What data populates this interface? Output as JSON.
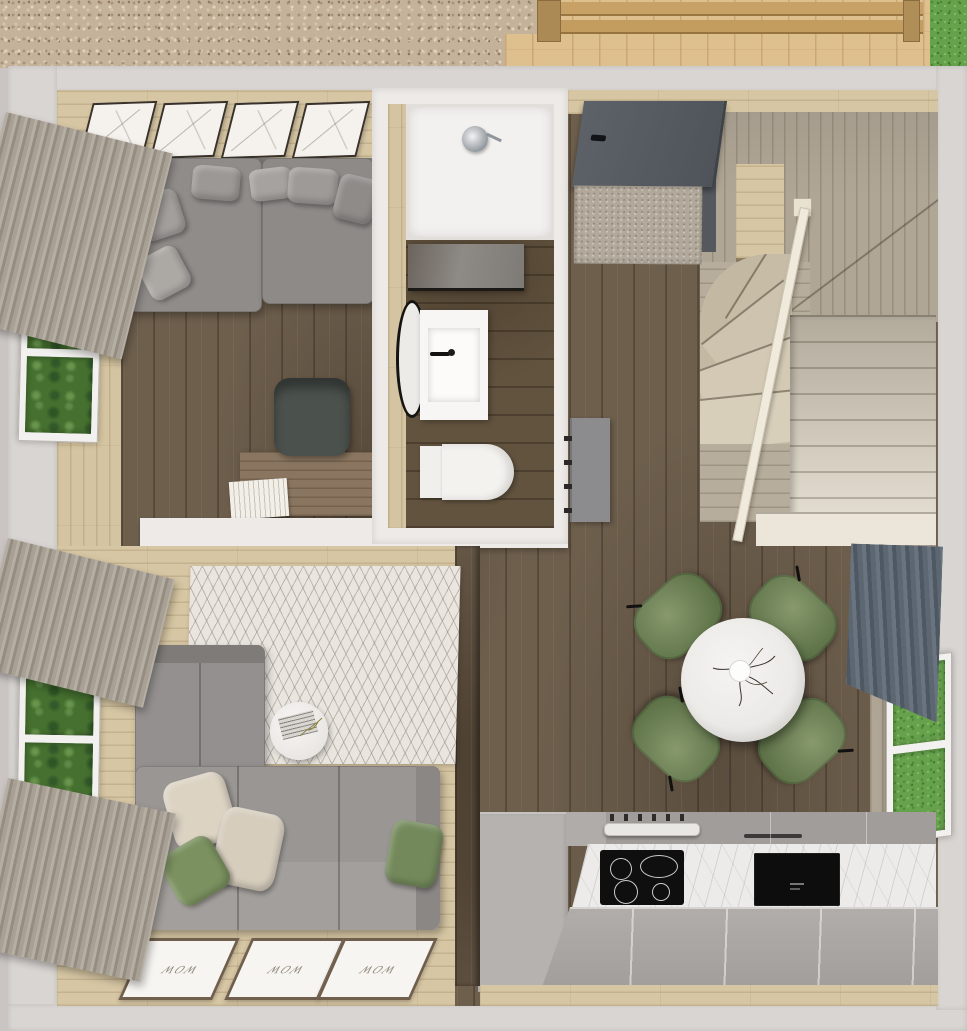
{
  "scene": {
    "type": "3D rendered floor plan, top-down view",
    "description": "Tiny house interior seen from above: lounge-office, bathroom, entry hall with winder staircase, dining corner, kitchen and living room. Gravel, a wooden pergola deck and lawn are visible outside."
  },
  "labels": {
    "floor_mat_text": "WOW"
  },
  "rooms": {
    "lounge_office": {
      "name": "Lounge / Office",
      "items": [
        "gray sectional sofa",
        "6 gray throw pillows",
        "4 framed botanical sketches",
        "wood desk",
        "dark office chair",
        "stack of books",
        "window with forest view",
        "gray pleated curtain"
      ]
    },
    "bathroom": {
      "name": "Bathroom",
      "items": [
        "walk-in shower with rain head",
        "glass panel",
        "round black-rim mirror",
        "white vanity sink with black faucet",
        "wall-hung toilet",
        "gray door"
      ]
    },
    "hallway": {
      "name": "Entry hall",
      "items": [
        "dark gray entry door",
        "door mat",
        "winder staircase",
        "cream handrail",
        "upper landing"
      ]
    },
    "dining": {
      "name": "Dining corner",
      "items": [
        "round white marble table",
        "vase with dry branches",
        "4 green upholstered chairs"
      ]
    },
    "kitchen": {
      "name": "Kitchen",
      "items": [
        "marble counter front",
        "black induction cooktop with 4 burners",
        "steel oven handle and knobs",
        "black built-in sink unit",
        "gray cabinet fronts"
      ]
    },
    "living_room": {
      "name": "Living room",
      "items": [
        "L-shaped gray sofa",
        "beige and green pillows",
        "round white side table with magazine",
        "chevron pattern rug",
        "3 WOW floor mats",
        "window with forest view",
        "two gray pleated curtains"
      ]
    },
    "exterior": {
      "name": "Exterior",
      "items": [
        "gravel bed",
        "wooden deck with pergola beams",
        "lawn patch",
        "window on right wall with lawn view",
        "dark slate curtain"
      ]
    }
  },
  "colors": {
    "outer_wall": "#d9d5d2",
    "dark_floor": "#6e5f4d",
    "light_wood": "#d6c6a3",
    "gray_wood": "#b0a696",
    "sofa_gray": "#96918f",
    "pillow_beige": "#d9d0c1",
    "accent_green": "#7b915f",
    "curtain_gray": "#a8a095",
    "curtain_slate": "#5d6771",
    "marble": "#edebe9",
    "cooktop_black": "#0f0f0f",
    "rug": "#eae5df",
    "grass": "#66a14c",
    "gravel": "#c5b29a",
    "door_gray": "#565b61",
    "stairs_light": "#ece6da"
  }
}
